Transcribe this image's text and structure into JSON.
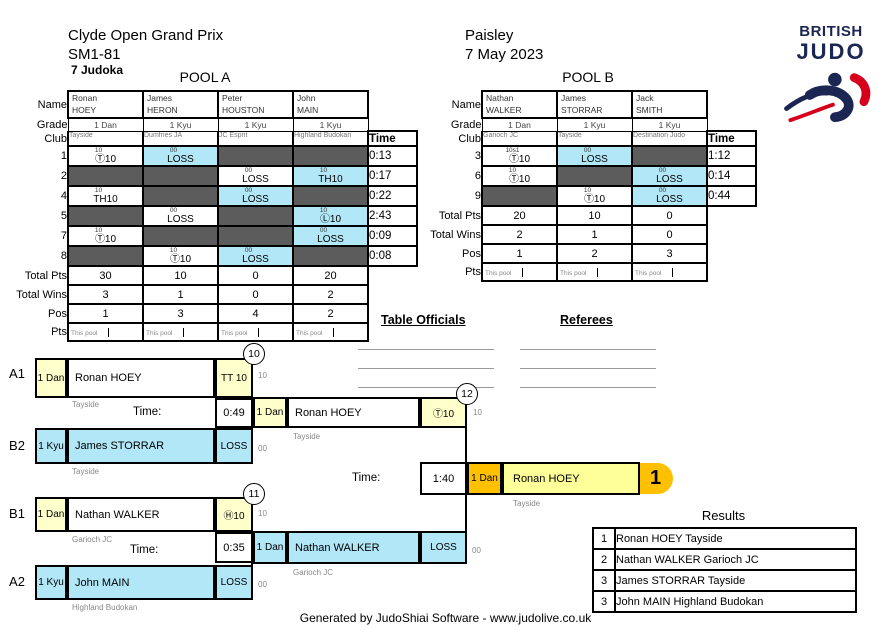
{
  "header": {
    "title": "Clyde Open Grand Prix",
    "category": "SM1-81",
    "judoka": "7 Judoka",
    "venue": "Paisley",
    "date": "7 May 2023"
  },
  "logo": {
    "line1": "BRITISH",
    "line2": "JUDO"
  },
  "labels": {
    "name": "Name",
    "grade": "Grade",
    "club": "Club",
    "total_pts": "Total Pts",
    "total_wins": "Total Wins",
    "pos": "Pos",
    "pts": "Pts",
    "time": "Time",
    "this_pool": "This pool",
    "time_colon": "Time:"
  },
  "pool_a": {
    "title": "POOL A",
    "players": [
      {
        "first": "Ronan",
        "last": "HOEY",
        "grade": "1 Dan",
        "club": "Tayside"
      },
      {
        "first": "James",
        "last": "HERON",
        "grade": "1 Kyu",
        "club": "Dumfries JA"
      },
      {
        "first": "Peter",
        "last": "HOUSTON",
        "grade": "1 Kyu",
        "club": "JC Esprit"
      },
      {
        "first": "John",
        "last": "MAIN",
        "grade": "1 Kyu",
        "club": "Highland Budokan"
      }
    ],
    "matches": [
      {
        "no": "1",
        "time": "0:13",
        "cells": [
          {
            "state": "white",
            "sup": "10",
            "score": "Ⓣ10"
          },
          {
            "state": "blue",
            "sup": "00",
            "score": "LOSS"
          },
          {
            "state": "dark"
          },
          {
            "state": "dark"
          }
        ]
      },
      {
        "no": "2",
        "time": "0:17",
        "cells": [
          {
            "state": "dark"
          },
          {
            "state": "dark"
          },
          {
            "state": "white",
            "sup": "00",
            "score": "LOSS"
          },
          {
            "state": "blue",
            "sup": "10",
            "score": "TH10"
          }
        ]
      },
      {
        "no": "4",
        "time": "0:22",
        "cells": [
          {
            "state": "white",
            "sup": "10",
            "score": "TH10"
          },
          {
            "state": "dark"
          },
          {
            "state": "blue",
            "sup": "00",
            "score": "LOSS"
          },
          {
            "state": "dark"
          }
        ]
      },
      {
        "no": "5",
        "time": "2:43",
        "cells": [
          {
            "state": "dark"
          },
          {
            "state": "white",
            "sup": "00",
            "score": "LOSS"
          },
          {
            "state": "dark"
          },
          {
            "state": "blue",
            "sup": "10",
            "score": "Ⓛ10"
          }
        ]
      },
      {
        "no": "7",
        "time": "0:09",
        "cells": [
          {
            "state": "white",
            "sup": "10",
            "score": "Ⓣ10"
          },
          {
            "state": "dark"
          },
          {
            "state": "dark"
          },
          {
            "state": "blue",
            "sup": "00",
            "score": "LOSS"
          }
        ]
      },
      {
        "no": "8",
        "time": "0:08",
        "cells": [
          {
            "state": "dark"
          },
          {
            "state": "white",
            "sup": "10",
            "score": "Ⓣ10"
          },
          {
            "state": "blue",
            "sup": "00",
            "score": "LOSS"
          },
          {
            "state": "dark"
          }
        ]
      }
    ],
    "total_pts": [
      "30",
      "10",
      "0",
      "20"
    ],
    "total_wins": [
      "3",
      "1",
      "0",
      "2"
    ],
    "pos": [
      "1",
      "3",
      "4",
      "2"
    ]
  },
  "pool_b": {
    "title": "POOL B",
    "players": [
      {
        "first": "Nathan",
        "last": "WALKER",
        "grade": "1 Dan",
        "club": "Garioch JC"
      },
      {
        "first": "James",
        "last": "STORRAR",
        "grade": "1 Kyu",
        "club": "Tayside"
      },
      {
        "first": "Jack",
        "last": "SMITH",
        "grade": "1 Kyu",
        "club": "Destination Judo"
      }
    ],
    "matches": [
      {
        "no": "3",
        "time": "1:12",
        "cells": [
          {
            "state": "white",
            "sup": "10s1",
            "score": "Ⓣ10"
          },
          {
            "state": "blue",
            "sup": "00",
            "score": "LOSS"
          },
          {
            "state": "dark"
          }
        ]
      },
      {
        "no": "6",
        "time": "0:14",
        "cells": [
          {
            "state": "white",
            "sup": "10",
            "score": "Ⓣ10"
          },
          {
            "state": "dark"
          },
          {
            "state": "blue",
            "sup": "00",
            "score": "LOSS"
          }
        ]
      },
      {
        "no": "9",
        "time": "0:44",
        "cells": [
          {
            "state": "dark"
          },
          {
            "state": "white",
            "sup": "10",
            "score": "Ⓣ10"
          },
          {
            "state": "blue",
            "sup": "00",
            "score": "LOSS"
          }
        ]
      }
    ],
    "total_pts": [
      "20",
      "10",
      "0"
    ],
    "total_wins": [
      "2",
      "1",
      "0"
    ],
    "pos": [
      "1",
      "2",
      "3"
    ]
  },
  "officials": {
    "table_officials": "Table Officials",
    "referees": "Referees"
  },
  "bracket": {
    "sf1": {
      "slot_top": "A1",
      "slot_bottom": "B2",
      "match_no": "10",
      "top": {
        "grade": "1 Dan",
        "name": "Ronan HOEY",
        "club": "Tayside",
        "score": "TT 10",
        "sup": "10"
      },
      "bottom": {
        "grade": "1 Kyu",
        "name": "James STORRAR",
        "club": "Tayside",
        "score": "LOSS",
        "sup": "00"
      },
      "time": "0:49"
    },
    "sf2": {
      "slot_top": "B1",
      "slot_bottom": "A2",
      "match_no": "11",
      "top": {
        "grade": "1 Dan",
        "name": "Nathan WALKER",
        "club": "Garioch JC",
        "score": "Ⓗ10",
        "sup": "10"
      },
      "bottom": {
        "grade": "1 Kyu",
        "name": "John MAIN",
        "club": "Highland Budokan",
        "score": "LOSS",
        "sup": "00"
      },
      "time": "0:35"
    },
    "final": {
      "match_no": "12",
      "top": {
        "grade": "1 Dan",
        "name": "Ronan HOEY",
        "club": "Tayside",
        "score": "Ⓣ10",
        "sup": "10"
      },
      "bottom": {
        "grade": "1 Dan",
        "name": "Nathan WALKER",
        "club": "Garioch JC",
        "score": "LOSS",
        "sup": "00"
      },
      "time": "1:40",
      "winner": {
        "grade": "1 Dan",
        "name": "Ronan HOEY",
        "club": "Tayside",
        "place": "1"
      }
    }
  },
  "results": {
    "title": "Results",
    "rows": [
      {
        "place": "1",
        "name": "Ronan HOEY Tayside"
      },
      {
        "place": "2",
        "name": "Nathan WALKER Garioch JC"
      },
      {
        "place": "3",
        "name": "James STORRAR Tayside"
      },
      {
        "place": "3",
        "name": "John MAIN Highland Budokan"
      }
    ]
  },
  "footer": "Generated by JudoShiai Software - www.judolive.co.uk",
  "colors": {
    "blue_cell": "#b2e7f8",
    "dark_cell": "#5c5c5c",
    "pale_yellow": "#ffffcc",
    "winner_yellow": "#ffff99",
    "orange": "#ffc000",
    "navy": "#1b2653",
    "red": "#d6001c"
  }
}
